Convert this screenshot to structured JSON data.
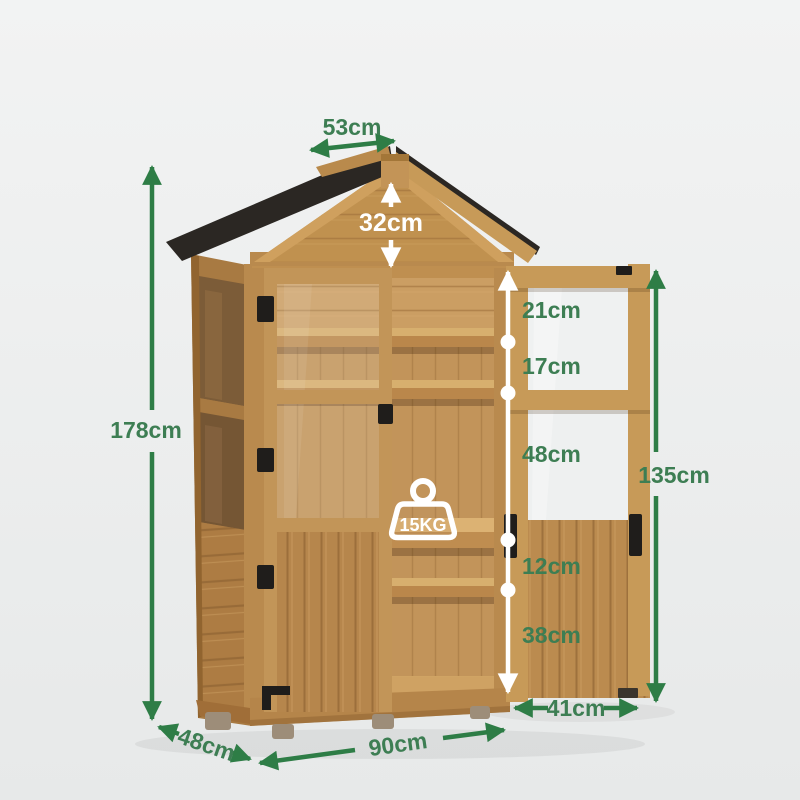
{
  "image_title": "Wooden garden greenhouse storage cabinet - dimension diagram",
  "colors": {
    "arrow_green": "#2e7d46",
    "label_green": "#3d7e53",
    "label_white": "#ffffff",
    "roof_black": "#2b2723",
    "wood_frame": "#c29456",
    "wood_slat": "#b4834a",
    "wood_back_wall": "#c2945a",
    "wood_groove": "#8a5e30",
    "background_top": "#f2f3f3",
    "background_bottom": "#e7e9e9"
  },
  "product": {
    "max_load": "15KG"
  },
  "measurements": {
    "roof_width": "53cm",
    "gable_height": "32cm",
    "total_height": "178cm",
    "inner_segments": [
      "21cm",
      "17cm",
      "48cm",
      "12cm",
      "38cm"
    ],
    "door_height": "135cm",
    "door_width": "41cm",
    "base_depth": "48cm",
    "base_width": "90cm"
  }
}
